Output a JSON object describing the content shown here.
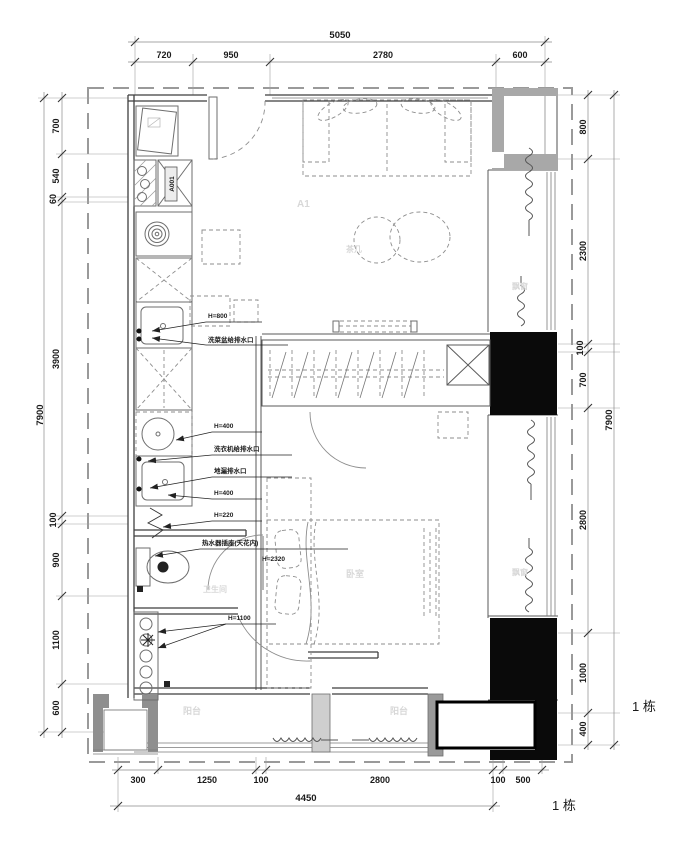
{
  "plan": {
    "building_label": "1 栋",
    "dims": {
      "top": {
        "total": "5050",
        "segments": [
          "720",
          "950",
          "2780",
          "600"
        ]
      },
      "bottom": {
        "total": "4450",
        "segments": [
          "300",
          "1250",
          "100",
          "2800",
          "100",
          "500"
        ]
      },
      "left": {
        "total": "7900",
        "segments": [
          "700",
          "540",
          "60",
          "3900",
          "100",
          "900",
          "1100",
          "600"
        ]
      },
      "right": {
        "total": "7900",
        "segments": [
          "800",
          "2300",
          "100",
          "700",
          "2800",
          "1000",
          "400"
        ]
      }
    },
    "rooms": {
      "living": "A1",
      "bedroom": "卧室",
      "bathroom": "卫生间",
      "balcony_left": "阳台",
      "balcony_right": "阳台",
      "bay_window_top": "飘窗",
      "bay_window_bottom": "飘窗",
      "coffee_table": "茶几"
    },
    "annotations": {
      "cabinet_code": "A001",
      "kitchen_sink_height": "H=800",
      "kitchen_sink_note": "洗菜盆给排水口",
      "basin_height": "H=400",
      "washer_note": "洗衣机给排水口",
      "floor_drain_note": "地漏排水口",
      "laundry_sink_height": "H=400",
      "low_point_height": "H=220",
      "water_heater_note": "热水器插座(天花内)",
      "water_heater_height": "H=2320",
      "switch_height": "H=1100"
    },
    "colors": {
      "line": "#3f3f3f",
      "dimension": "#333333",
      "faint_label": "#d8d8d8",
      "wall_fill": "#a6a6a6",
      "column_fill": "#0a0a0a"
    }
  }
}
